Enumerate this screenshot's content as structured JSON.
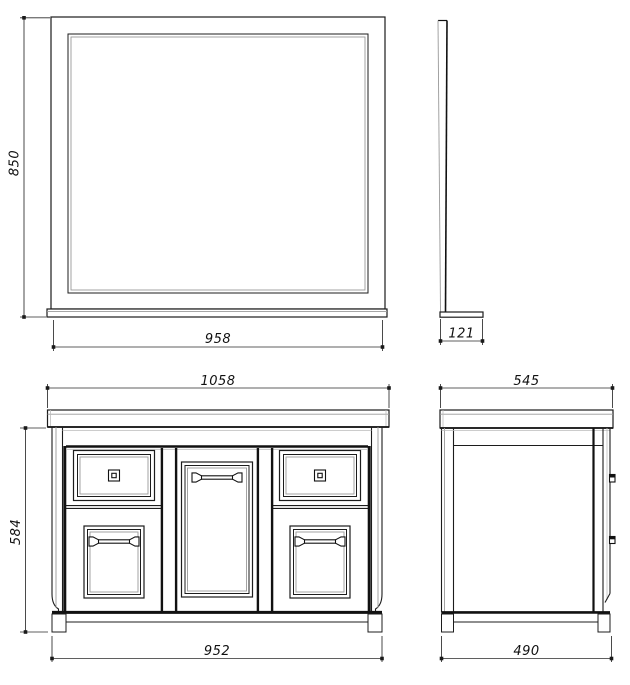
{
  "views": {
    "mirror_front": {
      "height_mm": "850",
      "width_mm": "958"
    },
    "mirror_side": {
      "depth_mm": "121"
    },
    "vanity_front": {
      "countertop_width_mm": "1058",
      "height_mm": "584",
      "cabinet_width_mm": "952"
    },
    "vanity_side": {
      "countertop_depth_mm": "545",
      "cabinet_depth_mm": "490"
    }
  },
  "colors": {
    "line": "#1c1c1c",
    "heavy_line": "#111111",
    "light_line": "#999999",
    "dimension": "#2a2a2a",
    "background": "#ffffff"
  }
}
